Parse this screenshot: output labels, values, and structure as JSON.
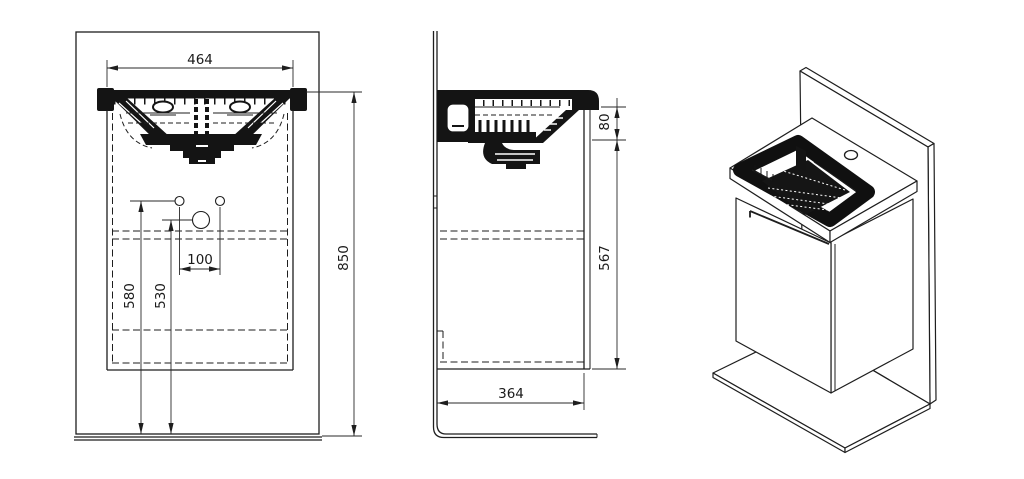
{
  "meta": {
    "title": "Washbasin vanity unit technical drawing",
    "background": "#ffffff",
    "line_color": "#1e1e1e"
  },
  "front": {
    "dim_basin_width": "464",
    "dim_overall_height": "850",
    "dim_connection_height_outer": "580",
    "dim_connection_height_inner": "530",
    "dim_connection_spacing": "100"
  },
  "side": {
    "dim_basin_apron_height": "80",
    "dim_cabinet_height": "567",
    "dim_cabinet_depth": "364"
  },
  "views": {
    "front_label": "front-view",
    "side_label": "side-view",
    "iso_label": "isometric-view"
  }
}
